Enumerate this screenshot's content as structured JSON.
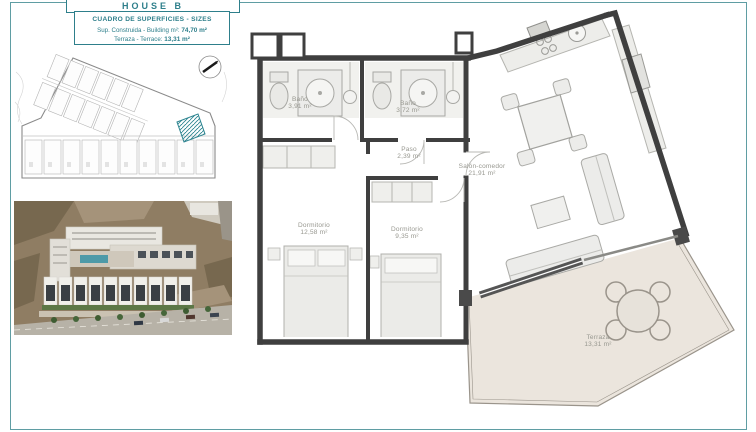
{
  "sheet": {
    "house_title": "HOUSE B",
    "surfaces": {
      "title": "CUADRO DE SUPERFICIES - SIZES",
      "built_label": "Sup. Construida - Building m²:",
      "built_value": "74,70 m²",
      "terrace_label": "Terraza - Terrace:",
      "terrace_value": "13,31 m²"
    }
  },
  "floor_plan": {
    "rooms": [
      {
        "name": "Baño",
        "area": "3,91 m²"
      },
      {
        "name": "Baño",
        "area": "3,72 m²"
      },
      {
        "name": "Paso",
        "area": "2,39 m²"
      },
      {
        "name": "Dormitorio",
        "area": "12,58 m²"
      },
      {
        "name": "Dormitorio",
        "area": "9,35 m²"
      },
      {
        "name": "Salón-comedor",
        "area": "21,91 m²"
      },
      {
        "name": "Terraza",
        "area": "13,31 m²"
      }
    ]
  },
  "colors": {
    "accent_teal": "#2e7f8b",
    "frame_teal": "#5f9da3",
    "wall": "#3f3f3f",
    "terrace_fill": "#ebe5dd",
    "plot_hatch": "#2e8591"
  }
}
